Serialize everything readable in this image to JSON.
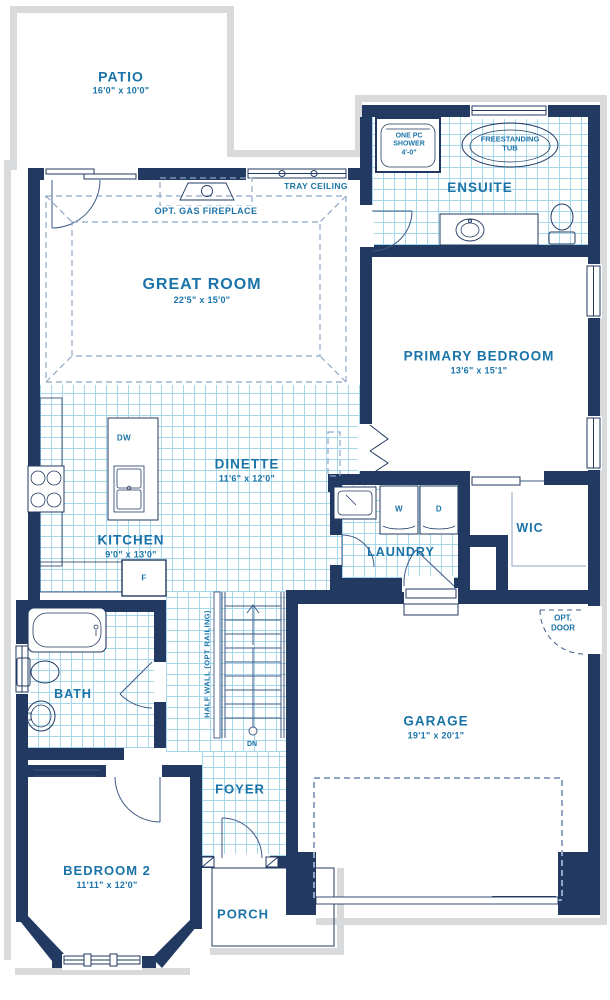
{
  "plan_title": "Main floor plan",
  "rooms": {
    "patio": {
      "label": "PATIO",
      "dims": "16'0\" x 10'0\""
    },
    "great_room": {
      "label": "GREAT ROOM",
      "dims": "22'5\" x 15'0\""
    },
    "ensuite": {
      "label": "ENSUITE"
    },
    "primary_bedroom": {
      "label": "PRIMARY BEDROOM",
      "dims": "13'6\" x 15'1\""
    },
    "dinette": {
      "label": "DINETTE",
      "dims": "11'6\" x 12'0\""
    },
    "kitchen": {
      "label": "KITCHEN",
      "dims": "9'0\" x 13'0\""
    },
    "laundry": {
      "label": "LAUNDRY"
    },
    "wic": {
      "label": "WIC"
    },
    "bath": {
      "label": "BATH"
    },
    "foyer": {
      "label": "FOYER"
    },
    "garage": {
      "label": "GARAGE",
      "dims": "19'1\" x 20'1\""
    },
    "bedroom_2": {
      "label": "BEDROOM 2",
      "dims": "11'11\" x 12'0\""
    },
    "porch": {
      "label": "PORCH"
    }
  },
  "annotations": {
    "tray_ceiling": "TRAY CEILING",
    "opt_gas_fireplace": "OPT. GAS FIREPLACE",
    "one_pc_shower_line1": "ONE PC",
    "one_pc_shower_line2": "SHOWER",
    "one_pc_shower_size": "4'-0\"",
    "freestanding_tub_line1": "FREESTANDING",
    "freestanding_tub_line2": "TUB",
    "half_wall": "HALF WALL (OPT RAILING)",
    "down": "DN",
    "opt_door_line1": "OPT.",
    "opt_door_line2": "DOOR",
    "washer": "W",
    "dryer": "D",
    "dishwasher": "DW",
    "fridge": "F"
  },
  "colors": {
    "walls": "#223a62",
    "room_text": "#1a73a8",
    "tile_grid": "#a5d8ec",
    "exterior_trim": "#d8dadc"
  }
}
